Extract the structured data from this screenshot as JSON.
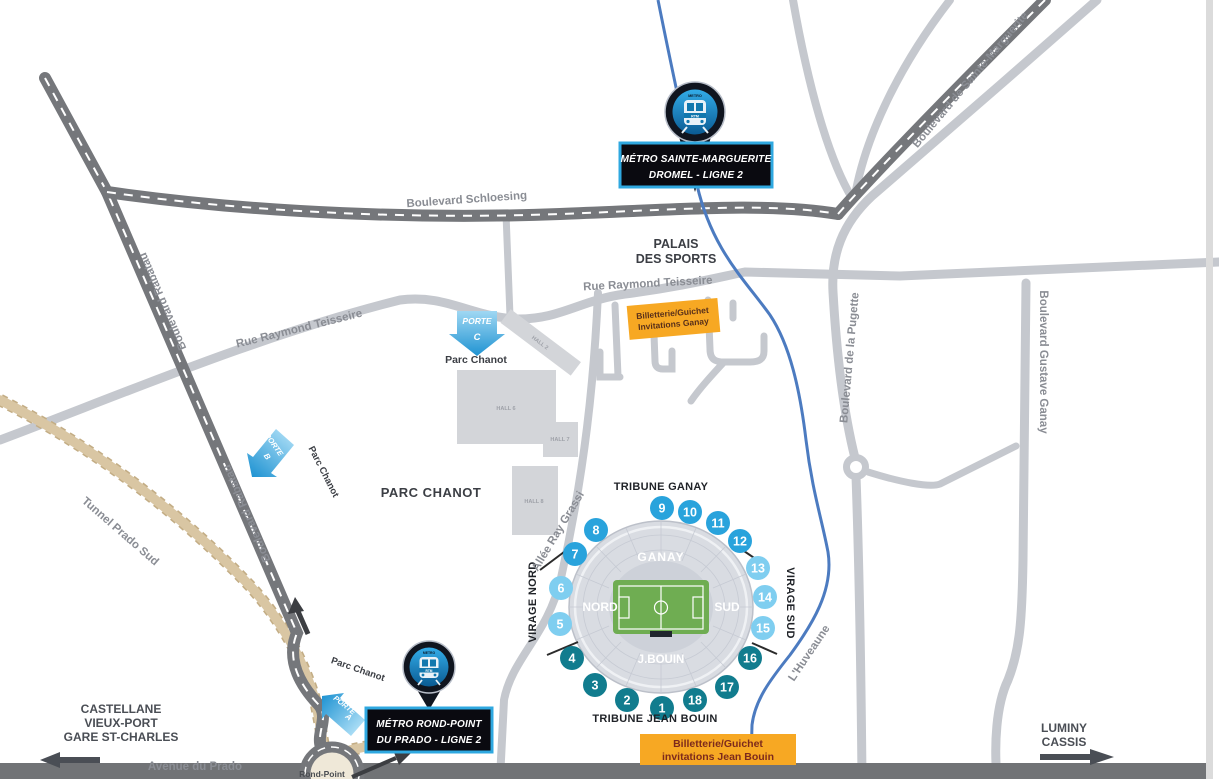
{
  "colors": {
    "accent_blue": "#2FA8E0",
    "orange": "#F7A823",
    "teal_dark": "#117C8E",
    "blue_mid": "#29A3DC",
    "blue_light": "#7FCEF0",
    "river_blue": "#4C7BC0",
    "road_dark": "#75777B",
    "road_light": "#C5C8CE",
    "tunnel_tan": "#D9C6A3"
  },
  "roads": {
    "rabatau": "Boulevard Rabatau",
    "schloesing": "Boulevard Schloesing",
    "sainte_marguerite": "Boulevard de Sainte-Marguerite",
    "teisseire": "Rue Raymond Teisseire",
    "pugette": "Boulevard de la Pugette",
    "gustave_ganay": "Boulevard Gustave Ganay",
    "allee_ray_grassi": "Allée Ray Grassi",
    "tunnel_prado_sud": "Tunnel Prado Sud",
    "avenue_du_prado": "Avenue du Prado",
    "huveaune": "L'Huveaune",
    "rond_point": "Rond-Point"
  },
  "places": {
    "palais_line1": "PALAIS",
    "palais_line2": "DES SPORTS",
    "parc_chanot": "PARC CHANOT",
    "parc_chanot_small": "Parc Chanot",
    "halls": [
      "HALL 2",
      "HALL 6",
      "HALL 7",
      "HALL 8"
    ]
  },
  "metro": {
    "station_dromel": {
      "line1": "MÉTRO SAINTE-MARGUERITE",
      "line2": "DROMEL - LIGNE 2"
    },
    "station_prado": {
      "line1": "MÉTRO ROND-POINT",
      "line2": "DU PRADO - LIGNE 2"
    },
    "logo": "RTM",
    "icon_caption": "METRO"
  },
  "portes": {
    "word": "PORTE",
    "a": "A",
    "b": "B",
    "c": "C"
  },
  "ticketing": {
    "ganay": {
      "line1": "Billetterie/Guichet",
      "line2": "Invitations Ganay"
    },
    "jean_bouin": {
      "line1": "Billetterie/Guichet",
      "line2": "invitations Jean Bouin"
    }
  },
  "destinations": {
    "west": [
      "CASTELLANE",
      "VIEUX-PORT",
      "GARE ST-CHARLES"
    ],
    "east": [
      "LUMINY",
      "CASSIS"
    ]
  },
  "stadium": {
    "tribune_north": "TRIBUNE GANAY",
    "tribune_south": "TRIBUNE JEAN BOUIN",
    "virage_nord": "VIRAGE NORD",
    "virage_sud": "VIRAGE SUD",
    "stand_ganay": "GANAY",
    "stand_nord": "NORD",
    "stand_sud": "SUD",
    "stand_jbouin": "J.BOUIN",
    "numbers": [
      {
        "n": "1",
        "color": "#117C8E"
      },
      {
        "n": "2",
        "color": "#117C8E"
      },
      {
        "n": "3",
        "color": "#117C8E"
      },
      {
        "n": "4",
        "color": "#117C8E"
      },
      {
        "n": "5",
        "color": "#7FCEF0"
      },
      {
        "n": "6",
        "color": "#7FCEF0"
      },
      {
        "n": "7",
        "color": "#29A3DC"
      },
      {
        "n": "8",
        "color": "#29A3DC"
      },
      {
        "n": "9",
        "color": "#29A3DC"
      },
      {
        "n": "10",
        "color": "#29A3DC"
      },
      {
        "n": "11",
        "color": "#29A3DC"
      },
      {
        "n": "12",
        "color": "#29A3DC"
      },
      {
        "n": "13",
        "color": "#7FCEF0"
      },
      {
        "n": "14",
        "color": "#7FCEF0"
      },
      {
        "n": "15",
        "color": "#7FCEF0"
      },
      {
        "n": "16",
        "color": "#117C8E"
      },
      {
        "n": "17",
        "color": "#117C8E"
      },
      {
        "n": "18",
        "color": "#117C8E"
      }
    ]
  }
}
